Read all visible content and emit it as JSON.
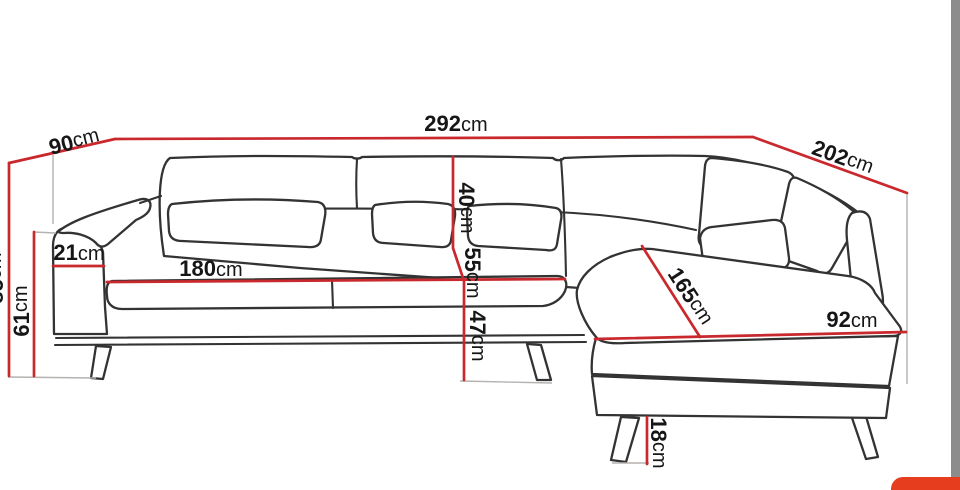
{
  "page": {
    "kind": "sofa-dimension-diagram",
    "background": "#ffffff",
    "accent_red": "#c9282d",
    "outline_color": "#333333",
    "guide_color": "#b5b2af"
  },
  "dims": {
    "total_width": {
      "num": "292",
      "unit": "cm"
    },
    "left_depth": {
      "num": "90",
      "unit": "cm"
    },
    "right_depth": {
      "num": "202",
      "unit": "cm"
    },
    "total_height": {
      "num": "85",
      "unit": "cm",
      "note": "partially cut off at left image edge"
    },
    "arm_height": {
      "num": "61",
      "unit": "cm"
    },
    "arm_width": {
      "num": "21",
      "unit": "cm"
    },
    "seat_width": {
      "num": "180",
      "unit": "cm"
    },
    "back_cushion_height": {
      "num": "40",
      "unit": "cm"
    },
    "seat_cushion_height": {
      "num": "55",
      "unit": "cm"
    },
    "seat_height": {
      "num": "47",
      "unit": "cm"
    },
    "chaise_length": {
      "num": "165",
      "unit": "cm"
    },
    "chaise_depth": {
      "num": "92",
      "unit": "cm"
    },
    "leg_height": {
      "num": "18",
      "unit": "cm"
    }
  },
  "ui": {
    "scrollbar_color": "#8c8c8c",
    "corner_button_color": "#e63d1e"
  }
}
